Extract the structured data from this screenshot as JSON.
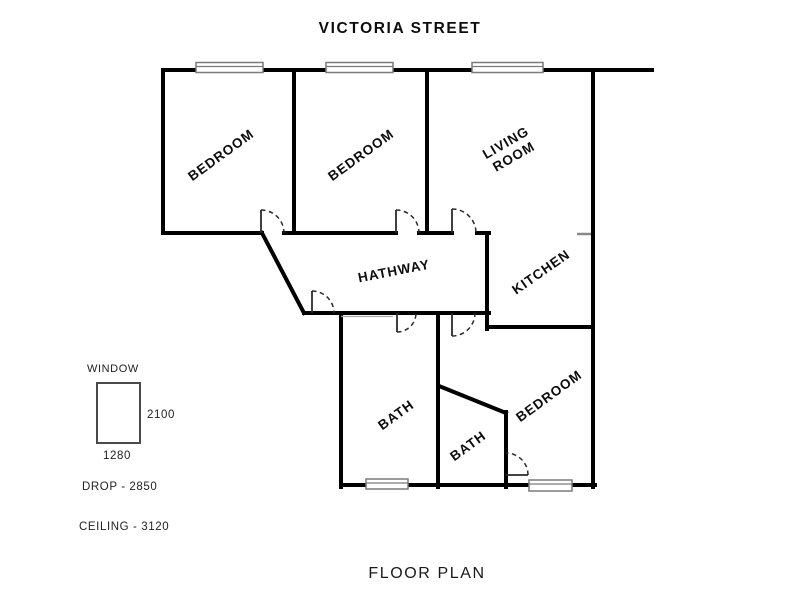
{
  "title": "VICTORIA STREET",
  "caption": "FLOOR PLAN",
  "rooms": {
    "bedroom1": "BEDROOM",
    "bedroom2": "BEDROOM",
    "living_line1": "LIVING",
    "living_line2": "ROOM",
    "kitchen": "KITCHEN",
    "hallway": "HATHWAY",
    "bath1": "BATH",
    "bath2": "BATH",
    "bedroom3": "BEDROOM"
  },
  "legend": {
    "window_label": "WINDOW",
    "window_height": "2100",
    "window_width": "1280",
    "drop": "DROP - 2850",
    "ceiling": "CEILING - 3120"
  },
  "colors": {
    "wall": "#000000",
    "door": "#2a2a2a",
    "window_frame": "#7a7a7a",
    "divider_gray": "#8a8a8a",
    "text": "#111111"
  }
}
